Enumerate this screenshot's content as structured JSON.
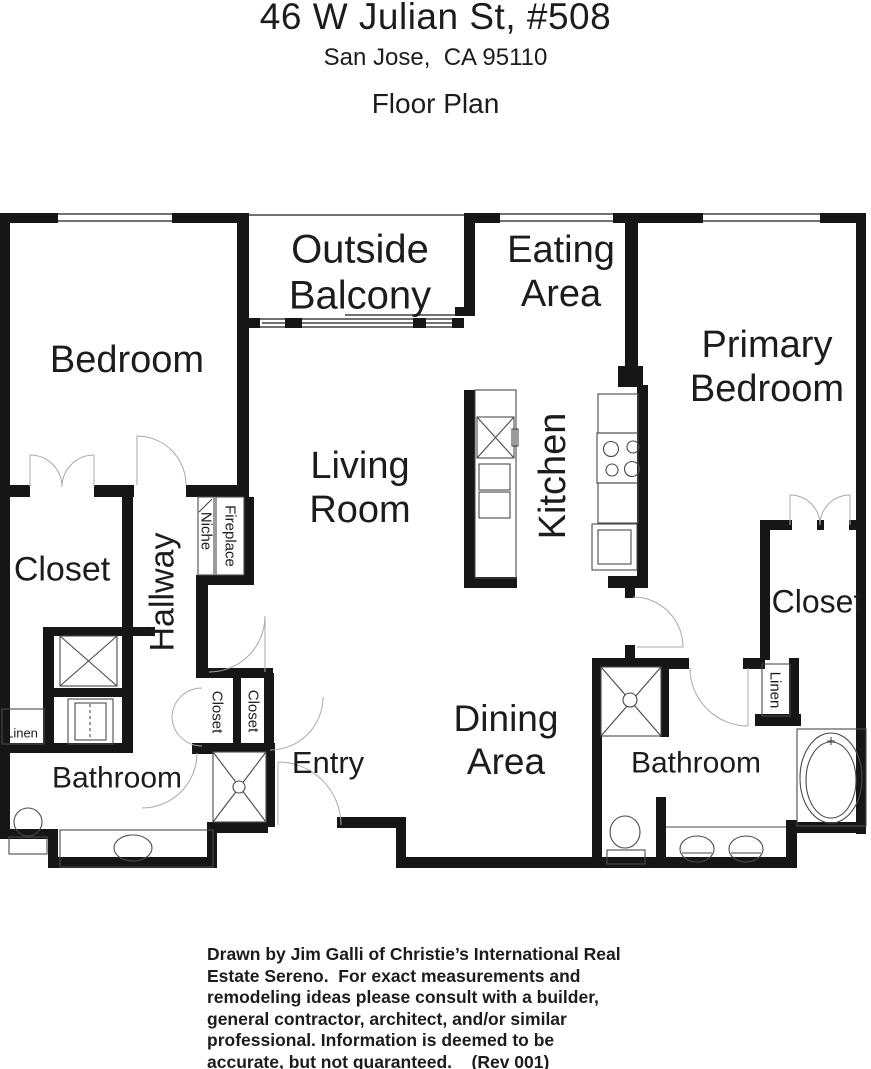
{
  "header": {
    "address": "46 W Julian St, #508",
    "city": "San Jose,  CA 95110",
    "plan_title": "Floor Plan"
  },
  "rooms": {
    "bedroom": "Bedroom",
    "outside_balcony": "Outside\nBalcony",
    "eating_area": "Eating\nArea",
    "primary_bedroom": "Primary\nBedroom",
    "living_room": "Living\nRoom",
    "kitchen": "Kitchen",
    "closet_left": "Closet",
    "hallway": "Hallway",
    "niche": "Niche",
    "fireplace": "Fireplace",
    "linen_left": "Linen",
    "bathroom_left": "Bathroom",
    "closet_hall_left": "Closet",
    "closet_hall_right": "Closet",
    "entry": "Entry",
    "dining_area": "Dining\nArea",
    "bathroom_right": "Bathroom",
    "closet_primary": "Closet",
    "linen_primary": "Linen"
  },
  "footer": {
    "disclaimer": "Drawn by Jim Galli of Christie’s International Real\nEstate Sereno.  For exact measurements and\nremodeling ideas please consult with a builder,\ngeneral contractor, architect, and/or similar\nprofessional. Information is deemed to be\naccurate, but not guaranteed.    (Rev 001)"
  },
  "colors": {
    "wall": "#161616",
    "text": "#1c1c1c",
    "door_arc": "#a9a9a9"
  }
}
